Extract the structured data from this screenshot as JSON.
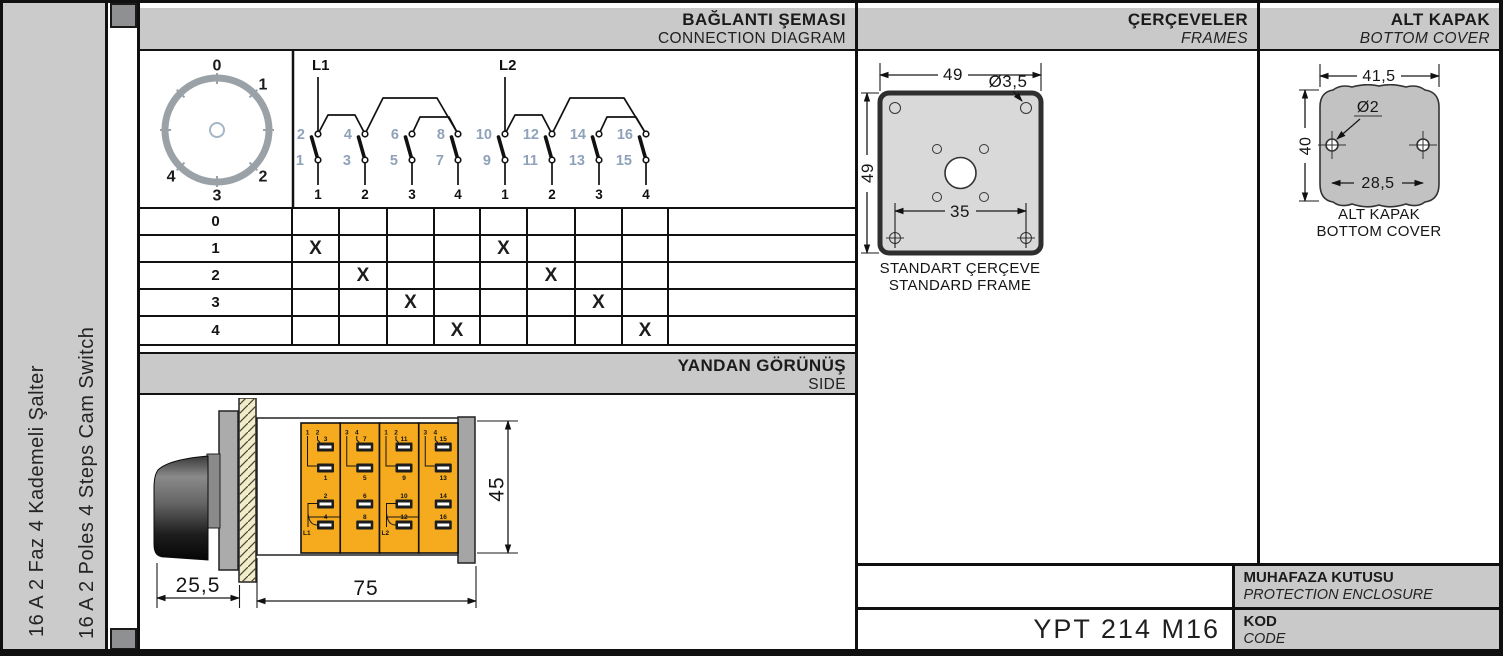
{
  "product": {
    "title_tr": "16 A 2 Faz 4 Kademeli Şalter",
    "title_en": "16 A 2 Poles 4 Steps Cam Switch"
  },
  "headers": {
    "connection": {
      "tr": "BAĞLANTI ŞEMASI",
      "en": "CONNECTION DIAGRAM"
    },
    "side": {
      "tr": "YANDAN GÖRÜNÜŞ",
      "en": "SIDE"
    },
    "frames": {
      "tr": "ÇERÇEVELER",
      "en": "FRAMES"
    },
    "bottom_cover": {
      "tr": "ALT KAPAK",
      "en": "BOTTOM COVER"
    },
    "protection": {
      "tr": "MUHAFAZA KUTUSU",
      "en": "PROTECTION ENCLOSURE"
    },
    "code": {
      "tr": "KOD",
      "en": "CODE"
    }
  },
  "code_value": "YPT 214 M16",
  "dial": {
    "labels": [
      "0",
      "1",
      "2",
      "3",
      "4"
    ]
  },
  "connection_diagram": {
    "groups": [
      {
        "feed": "L1",
        "switches": [
          {
            "upper": "2",
            "lower": "1",
            "position": "1"
          },
          {
            "upper": "4",
            "lower": "3",
            "position": "2"
          },
          {
            "upper": "6",
            "lower": "5",
            "position": "3"
          },
          {
            "upper": "8",
            "lower": "7",
            "position": "4"
          }
        ]
      },
      {
        "feed": "L2",
        "switches": [
          {
            "upper": "10",
            "lower": "9",
            "position": "1"
          },
          {
            "upper": "12",
            "lower": "11",
            "position": "2"
          },
          {
            "upper": "14",
            "lower": "13",
            "position": "3"
          },
          {
            "upper": "16",
            "lower": "15",
            "position": "4"
          }
        ]
      }
    ]
  },
  "switching_table": {
    "mark": "X",
    "row_labels": [
      "0",
      "1",
      "2",
      "3",
      "4"
    ],
    "marks": [
      [
        0,
        0,
        0,
        0,
        0,
        0,
        0,
        0
      ],
      [
        1,
        0,
        0,
        0,
        1,
        0,
        0,
        0
      ],
      [
        0,
        1,
        0,
        0,
        0,
        1,
        0,
        0
      ],
      [
        0,
        0,
        1,
        0,
        0,
        0,
        1,
        0
      ],
      [
        0,
        0,
        0,
        1,
        0,
        0,
        0,
        1
      ]
    ]
  },
  "frame_drawing": {
    "dim_width": "49",
    "dim_height": "49",
    "dim_hole": "Ø3,5",
    "dim_hole_spacing": "35",
    "caption_tr": "STANDART ÇERÇEVE",
    "caption_en": "STANDARD FRAME"
  },
  "cover_drawing": {
    "dim_width": "41,5",
    "dim_height": "40",
    "dim_hole": "Ø2",
    "dim_hole_spacing": "28,5",
    "caption_tr": "ALT KAPAK",
    "caption_en": "BOTTOM COVER"
  },
  "side_view": {
    "dims": {
      "knob_depth": "25,5",
      "body_length": "75",
      "body_height": "45"
    },
    "modules": [
      {
        "top_labels": [
          "1",
          "2"
        ],
        "upper_terminals": [
          "3",
          "1"
        ],
        "lower_terminals": [
          "2",
          "4"
        ],
        "feed": "L1"
      },
      {
        "top_labels": [
          "3",
          "4"
        ],
        "upper_terminals": [
          "7",
          "5"
        ],
        "lower_terminals": [
          "6",
          "8"
        ],
        "feed": ""
      },
      {
        "top_labels": [
          "1",
          "2"
        ],
        "upper_terminals": [
          "11",
          "9"
        ],
        "lower_terminals": [
          "10",
          "12"
        ],
        "feed": "L2"
      },
      {
        "top_labels": [
          "3",
          "4"
        ],
        "upper_terminals": [
          "15",
          "13"
        ],
        "lower_terminals": [
          "14",
          "16"
        ],
        "feed": ""
      }
    ]
  },
  "colors": {
    "band_gray": "#c9c9c9",
    "punch_gray": "#8e9092",
    "module_yellow": "#f5ab1d",
    "frame_gray": "#d9d9d9",
    "cover_gray": "#c2c2c2",
    "terminal_number_blue": "#8fa2ba",
    "hatch_cream": "#f2ecca",
    "dial_ring_gray": "#9aa2a8"
  }
}
